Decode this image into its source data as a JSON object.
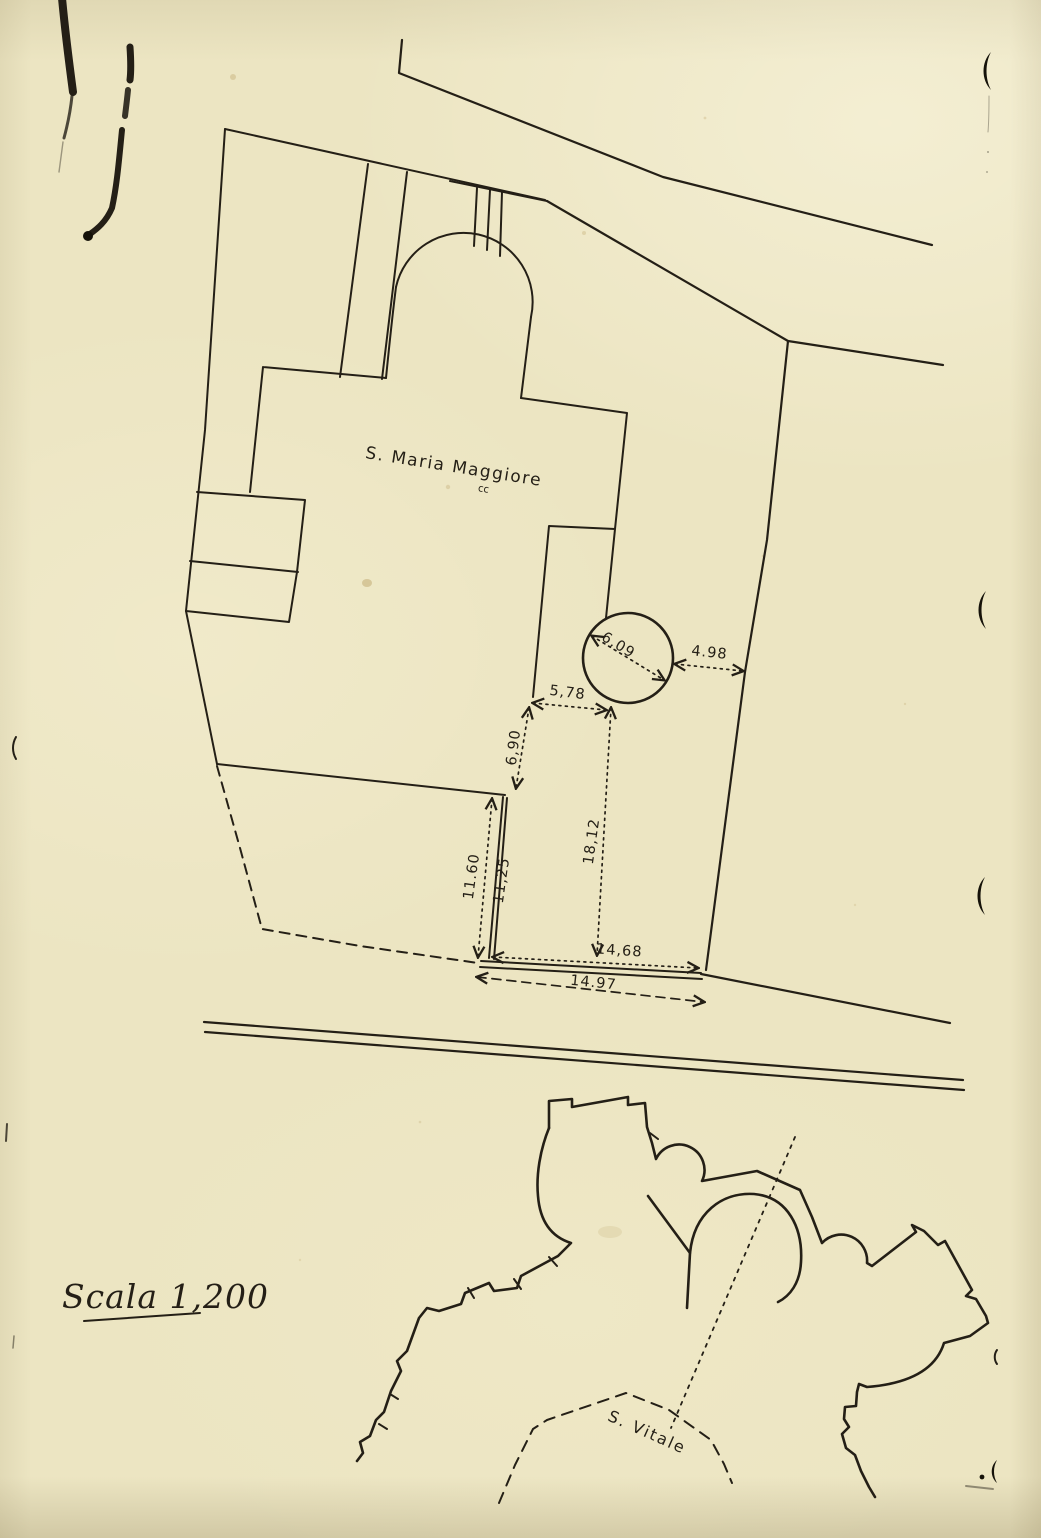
{
  "page": {
    "paper_color": "#ece5c2",
    "ink_color": "#241f16"
  },
  "upper_plan": {
    "building_label": "S. Maria Maggiore",
    "handwritten_mark": "cc",
    "dimensions": {
      "tower_diameter": "6,09",
      "tower_to_east_boundary": "4.98",
      "court_top_width": "5,78",
      "court_left_step": "6,90",
      "west_wall_outer": "11.60",
      "west_wall_inner": "11,25",
      "court_depth": "18,12",
      "south_side_inner": "14,68",
      "south_side_outer": "14.97"
    }
  },
  "lower_plan": {
    "building_label": "S. Vitale"
  },
  "scale_note": "Scala 1,200"
}
